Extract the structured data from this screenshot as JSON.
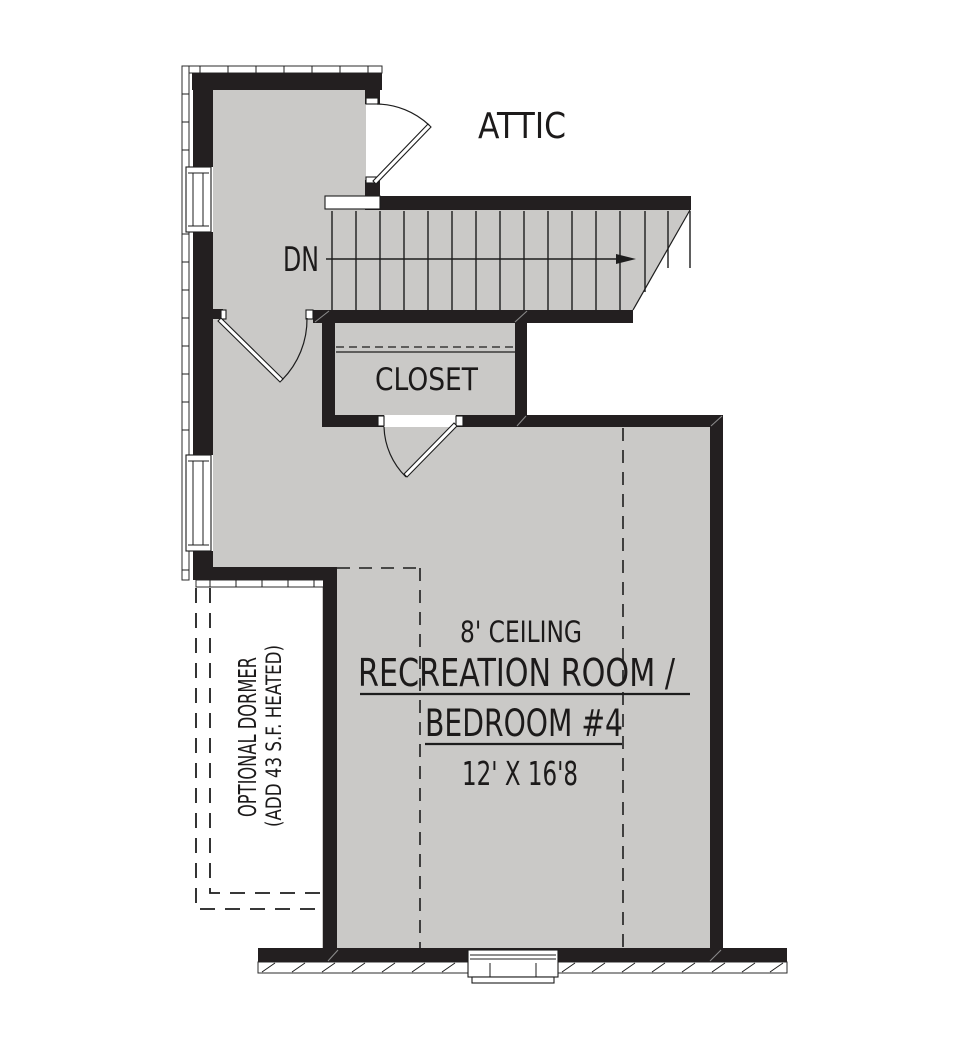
{
  "labels": {
    "attic": "ATTIC",
    "stairs_direction": "DN",
    "closet": "CLOSET",
    "room_ceiling": "8' CEILING",
    "room_name_line1": "RECREATION ROOM /",
    "room_name_line2": "BEDROOM #4",
    "room_dimensions": "12' X 16'8",
    "dormer_line1": "OPTIONAL DORMER",
    "dormer_line2": "(ADD 43 S.F. HEATED)"
  },
  "colors": {
    "wall": "#231f20",
    "floor_fill": "#cac9c7",
    "line": "#1d1d1d",
    "background": "#ffffff"
  }
}
